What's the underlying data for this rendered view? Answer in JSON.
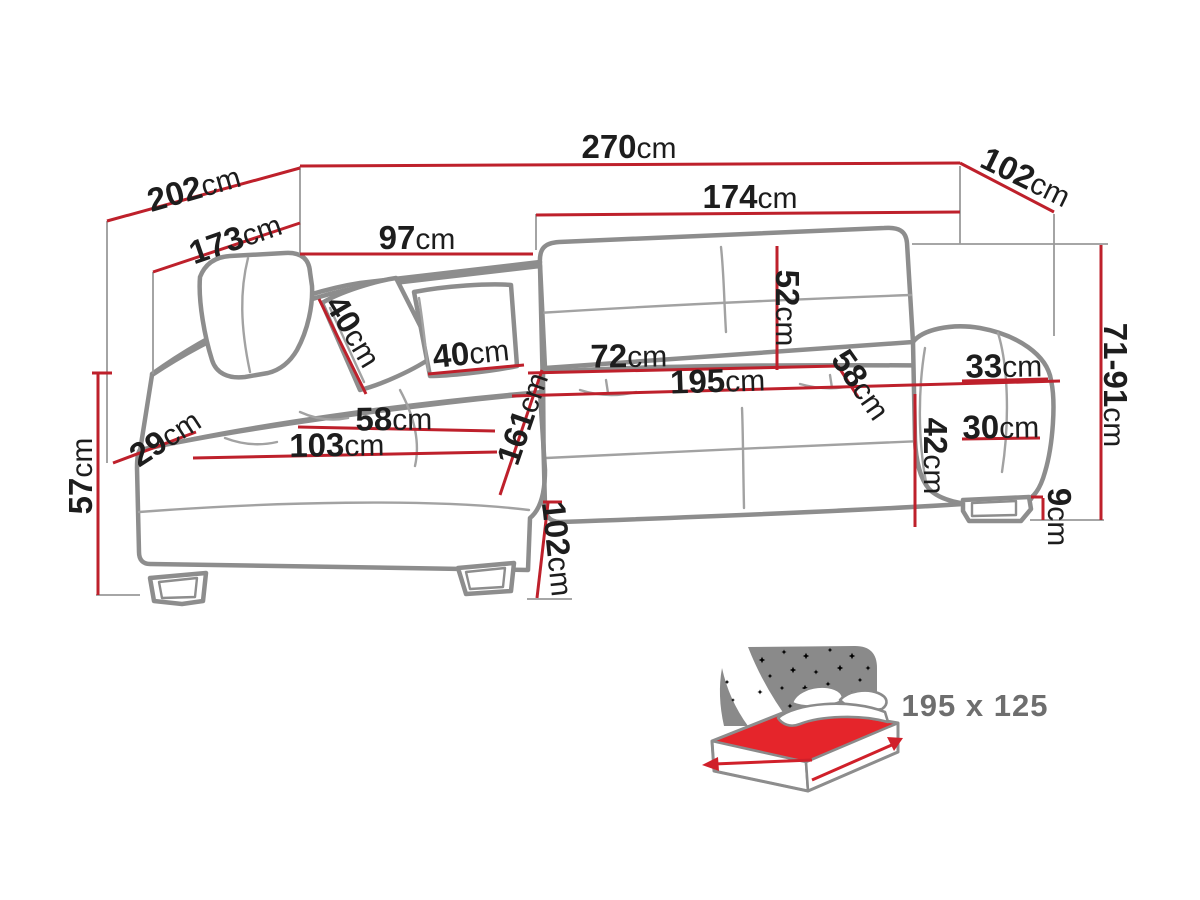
{
  "diagram": {
    "title": "corner-sofa-dimension-diagram",
    "unit": "cm",
    "dims": [
      {
        "id": "back-edge-left-total",
        "value": "202",
        "unit": "cm"
      },
      {
        "id": "top-width-total",
        "value": "270",
        "unit": "cm"
      },
      {
        "id": "side-depth-right",
        "value": "102",
        "unit": "cm"
      },
      {
        "id": "back-edge-left-inner",
        "value": "173",
        "unit": "cm"
      },
      {
        "id": "corner-back-top",
        "value": "97",
        "unit": "cm"
      },
      {
        "id": "main-back-width",
        "value": "174",
        "unit": "cm"
      },
      {
        "id": "backrest-height",
        "value": "52",
        "unit": "cm"
      },
      {
        "id": "pillow-left",
        "value": "40",
        "unit": "cm"
      },
      {
        "id": "pillow-right",
        "value": "40",
        "unit": "cm"
      },
      {
        "id": "seat-section-width",
        "value": "72",
        "unit": "cm"
      },
      {
        "id": "sleeping-width",
        "value": "195",
        "unit": "cm"
      },
      {
        "id": "seat-depth-right",
        "value": "58",
        "unit": "cm"
      },
      {
        "id": "armrest-top-width",
        "value": "33",
        "unit": "cm"
      },
      {
        "id": "armrest-lower-width",
        "value": "30",
        "unit": "cm"
      },
      {
        "id": "seat-height-front",
        "value": "42",
        "unit": "cm"
      },
      {
        "id": "back-height-adjustable",
        "value": "71-91",
        "unit": "cm"
      },
      {
        "id": "leg-height",
        "value": "9",
        "unit": "cm"
      },
      {
        "id": "chaise-seat-depth",
        "value": "58",
        "unit": "cm"
      },
      {
        "id": "chaise-seat-width",
        "value": "103",
        "unit": "cm"
      },
      {
        "id": "chaise-side",
        "value": "29",
        "unit": "cm"
      },
      {
        "id": "chaise-total-depth",
        "value": "161",
        "unit": "cm"
      },
      {
        "id": "height-to-seat",
        "value": "57",
        "unit": "cm"
      },
      {
        "id": "chaise-front-depth",
        "value": "102",
        "unit": "cm"
      }
    ],
    "bed": {
      "icon": "sleeping-area-icon",
      "size_label": "195 x 125"
    },
    "colors": {
      "dimension_line": "#be202b",
      "sofa_outline": "#8d8d8d",
      "label_text": "#1d1d1d",
      "bed_accent_red": "#e5252b",
      "bed_gray": "#8a8a8a",
      "size_label_gray": "#6e6e6e",
      "background": "#ffffff"
    }
  }
}
